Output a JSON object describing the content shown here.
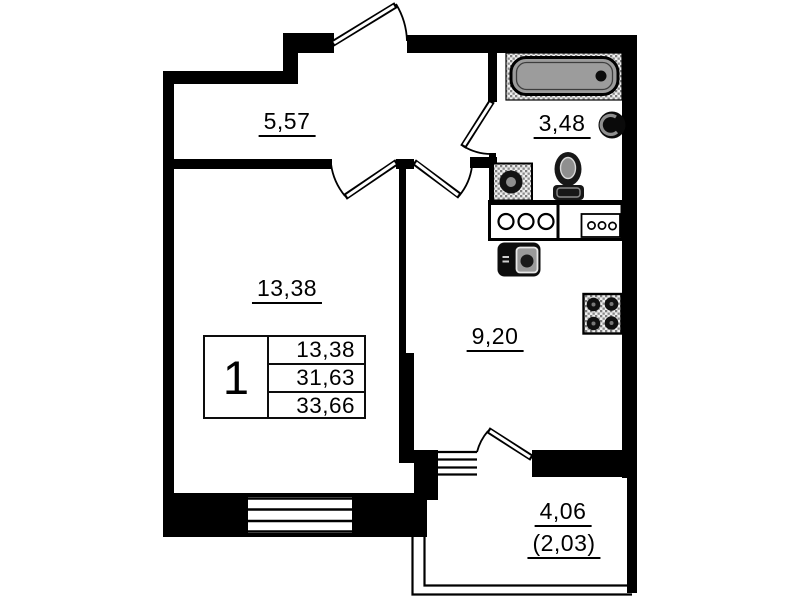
{
  "plan": {
    "rooms": {
      "hallway": {
        "area": "5,57"
      },
      "bathroom": {
        "area": "3,48"
      },
      "living_room": {
        "area": "13,38"
      },
      "kitchen": {
        "area": "9,20"
      },
      "balcony": {
        "area": "4,06",
        "area_with_coefficient": "(2,03)"
      }
    },
    "legend": {
      "rooms_count": "1",
      "living_area": "13,38",
      "area": "31,63",
      "total_area": "33,66"
    },
    "fixtures": [
      "bathtub",
      "wash-basin",
      "toilet",
      "washing-machine",
      "kitchen-counter",
      "kitchen-sink",
      "stove-4-burner"
    ],
    "colors": {
      "walls": "#000000",
      "background": "#ffffff",
      "bathtub_fill": "#9c9c9c"
    }
  }
}
